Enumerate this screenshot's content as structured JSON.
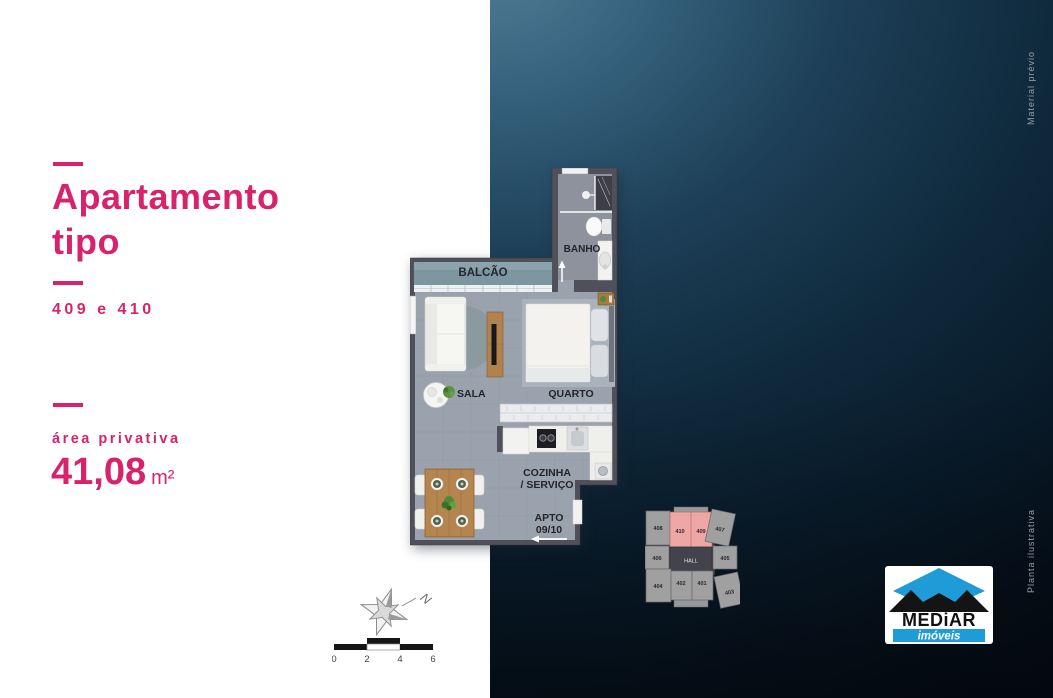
{
  "accent": "#d8226c",
  "sidebar": {
    "title_line1": "Apartamento",
    "title_line2": "tipo",
    "units_label": "409 e 410",
    "area_label": "área privativa",
    "area_value": "41,08",
    "area_unit": "m²"
  },
  "floorplan": {
    "balcony": "BALCÃO",
    "bathroom": "BANHO",
    "living": "SALA",
    "bedroom": "QUARTO",
    "kitchen_line1": "COZINHA",
    "kitchen_line2": "/ SERVIÇO",
    "apto_line1": "APTO",
    "apto_line2": "09/10"
  },
  "keyplan": {
    "hall": "HALL",
    "units": [
      "408",
      "410",
      "409",
      "407",
      "406",
      "405",
      "404",
      "402",
      "401",
      "403"
    ],
    "highlight_color": "#efa7a5"
  },
  "scalebar": {
    "ticks": [
      "0",
      "2",
      "4",
      "6"
    ]
  },
  "compass": {
    "north": "N"
  },
  "logo": {
    "brand": "MEDiAR",
    "tagline": "imóveis",
    "blue": "#1f9bd7"
  },
  "margin_notes": {
    "top_right": "Material prévio",
    "bottom_right": "Planta ilustrativa"
  }
}
